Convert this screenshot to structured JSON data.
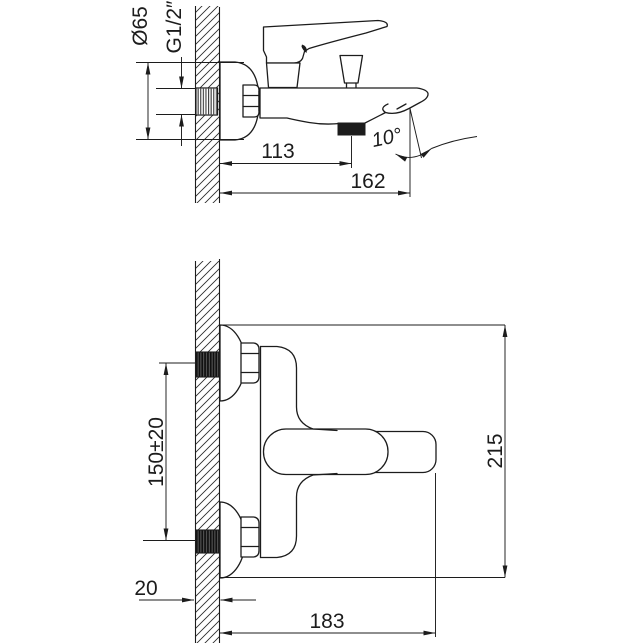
{
  "dimensions": {
    "top_view": {
      "flange_diameter": "Ø65",
      "thread_size": "G1/2″",
      "spout_reach": "113",
      "total_reach": "162",
      "spout_angle": "10°"
    },
    "front_view": {
      "inlet_spacing": "150±20",
      "overall_height": "215",
      "wall_thickness": "20",
      "overall_width": "183"
    }
  },
  "colors": {
    "line": "#1c1c1c",
    "background": "#ffffff",
    "aerator_fill": "#000000"
  }
}
